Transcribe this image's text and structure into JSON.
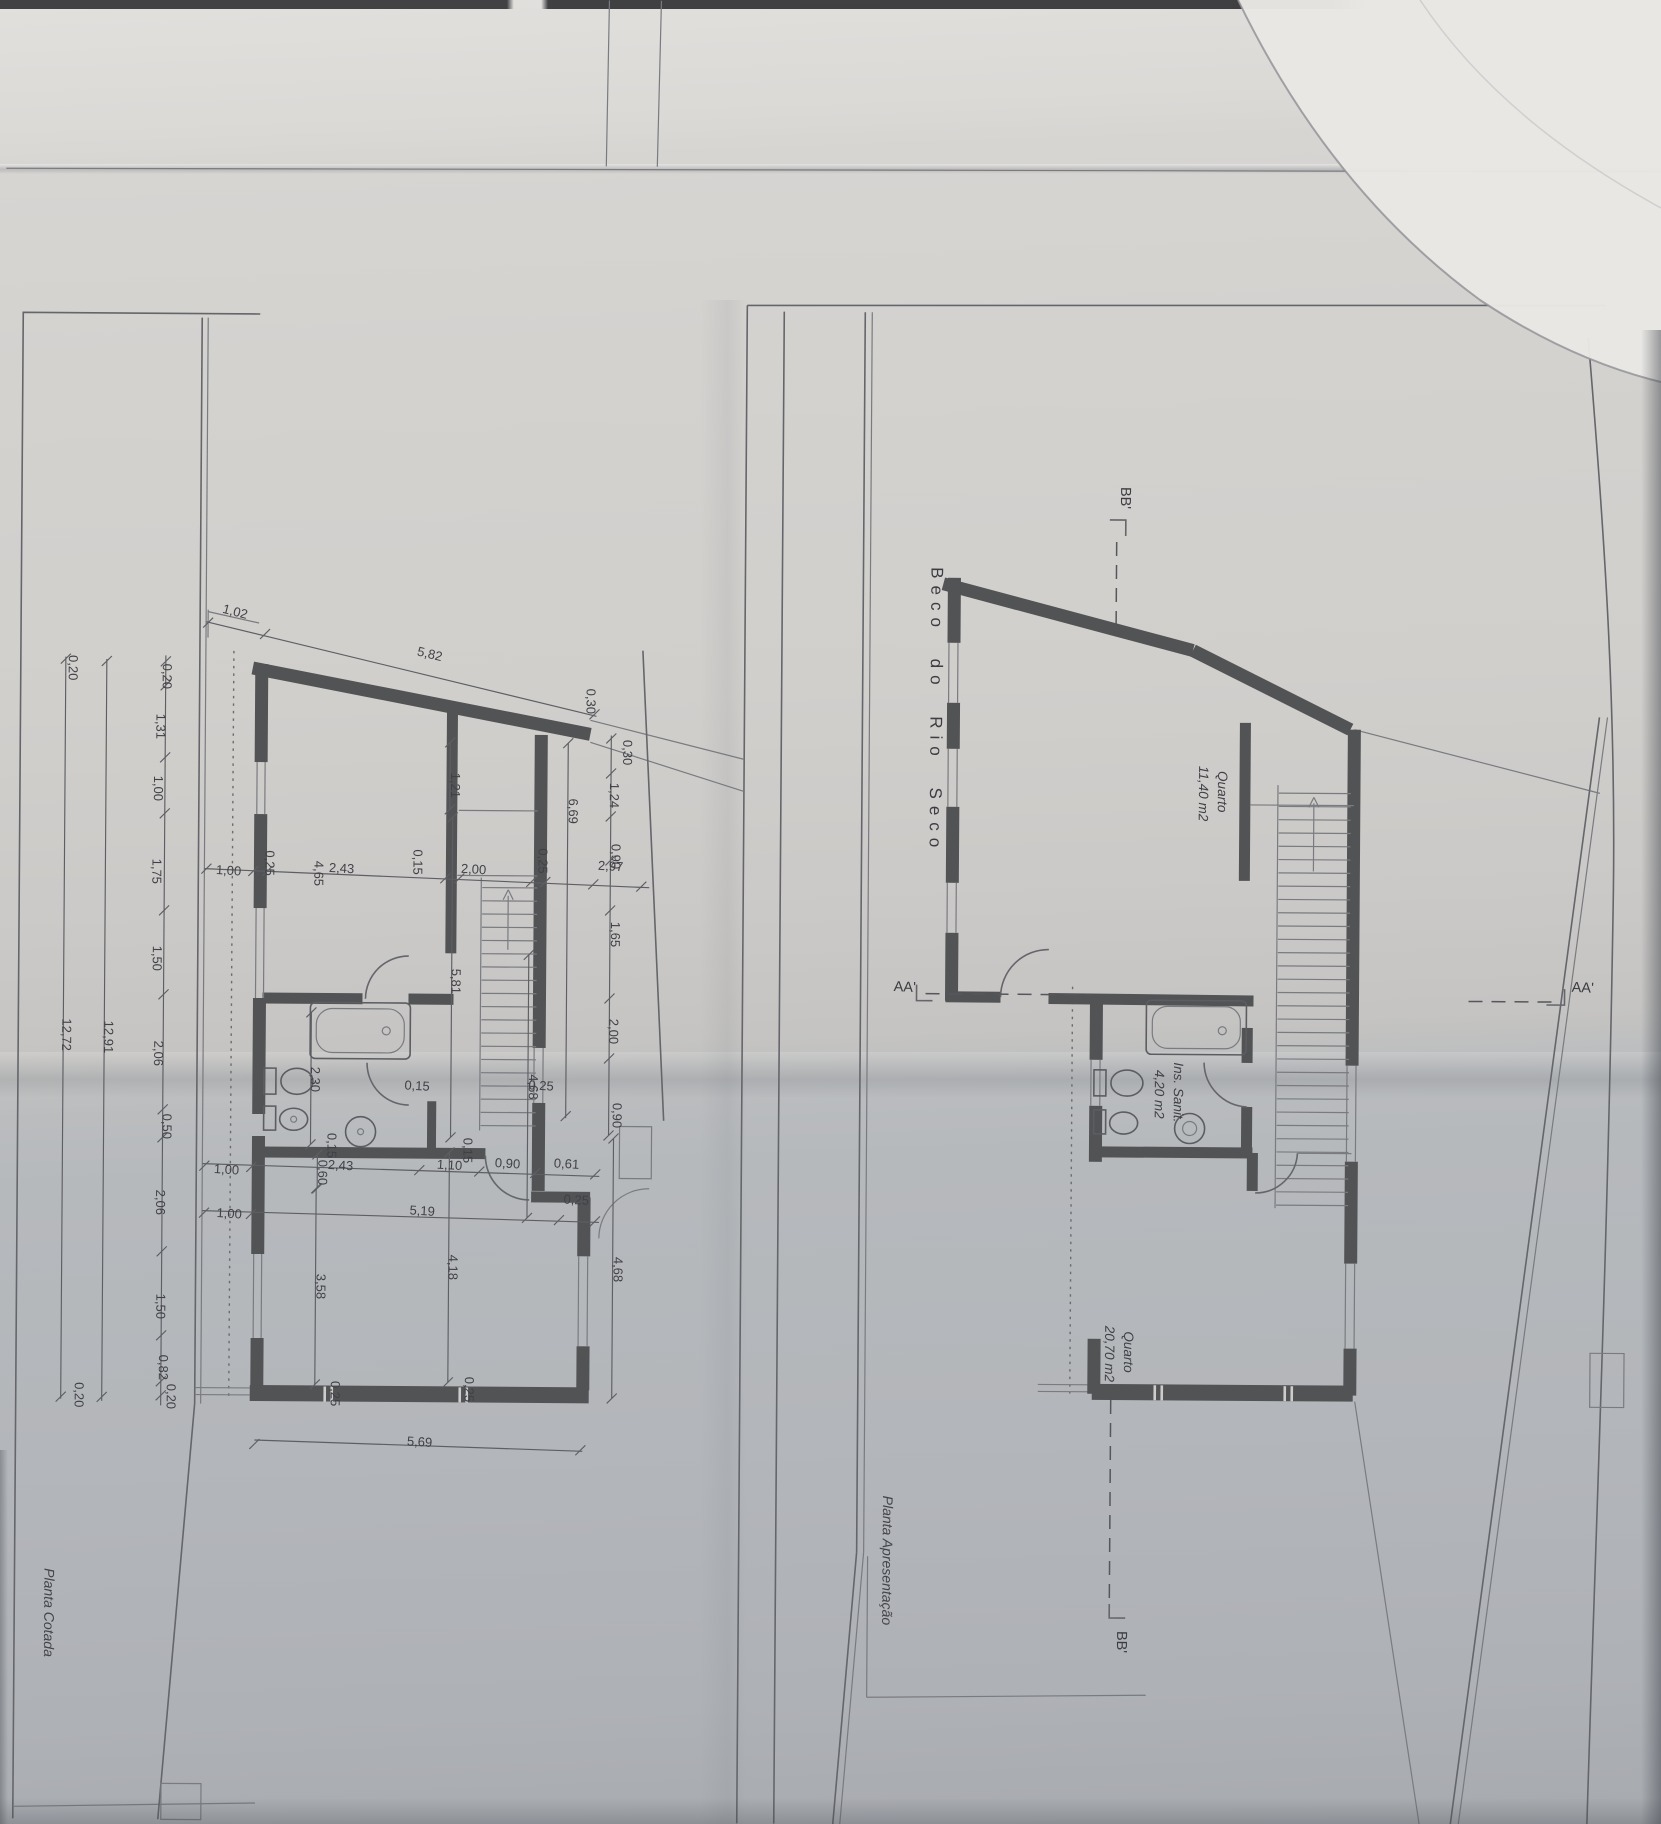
{
  "colors": {
    "paper_top": "#dbd9d6",
    "paper_bottom": "#aeb1b6",
    "wall_ink": "#525355",
    "line_ink": "#64666b",
    "text_ink": "#404147"
  },
  "left_plan": {
    "caption": "Planta Cotada",
    "caption_pos": {
      "x": 48,
      "y": 1618,
      "r": 90
    },
    "dimensions": [
      {
        "t": "0,20",
        "x": 160,
        "y": 681,
        "r": 90
      },
      {
        "t": "1,31",
        "x": 154,
        "y": 731,
        "r": 90
      },
      {
        "t": "1,00",
        "x": 152,
        "y": 793,
        "r": 90
      },
      {
        "t": "1,75",
        "x": 151,
        "y": 876,
        "r": 90
      },
      {
        "t": "1,50",
        "x": 152,
        "y": 963,
        "r": 90
      },
      {
        "t": "2,06",
        "x": 154,
        "y": 1058,
        "r": 90
      },
      {
        "t": "0,50",
        "x": 163,
        "y": 1131,
        "r": 90
      },
      {
        "t": "2,06",
        "x": 157,
        "y": 1207,
        "r": 90
      },
      {
        "t": "1,50",
        "x": 158,
        "y": 1311,
        "r": 90
      },
      {
        "t": "0,82",
        "x": 161,
        "y": 1372,
        "r": 90
      },
      {
        "t": "0,20",
        "x": 169,
        "y": 1401,
        "r": 90
      },
      {
        "t": "12,91",
        "x": 104,
        "y": 1042,
        "r": 90
      },
      {
        "t": "12,72",
        "x": 62,
        "y": 1040,
        "r": 90
      },
      {
        "t": "0,20",
        "x": 66,
        "y": 673,
        "r": 90
      },
      {
        "t": "0,20",
        "x": 77,
        "y": 1400,
        "r": 90
      },
      {
        "t": "1,02",
        "x": 231,
        "y": 620,
        "r": 14
      },
      {
        "t": "5,82",
        "x": 426,
        "y": 661,
        "r": 13
      },
      {
        "t": "1,00",
        "x": 227,
        "y": 879,
        "r": 3
      },
      {
        "t": "0,25",
        "x": 264,
        "y": 867,
        "r": 90
      },
      {
        "t": "4,65",
        "x": 313,
        "y": 877,
        "r": 90
      },
      {
        "t": "2,43",
        "x": 340,
        "y": 876,
        "r": 3
      },
      {
        "t": "0,15",
        "x": 412,
        "y": 865,
        "r": 90
      },
      {
        "t": "2,00",
        "x": 472,
        "y": 876,
        "r": 3
      },
      {
        "t": "0,25",
        "x": 537,
        "y": 863,
        "r": 90
      },
      {
        "t": "2,97",
        "x": 609,
        "y": 872,
        "r": 3
      },
      {
        "t": "0,30",
        "x": 621,
        "y": 754,
        "r": 90
      },
      {
        "t": "1,24",
        "x": 608,
        "y": 797,
        "r": 90
      },
      {
        "t": "0,90",
        "x": 610,
        "y": 858,
        "r": 90
      },
      {
        "t": "1,65",
        "x": 610,
        "y": 936,
        "r": 90
      },
      {
        "t": "2,00",
        "x": 609,
        "y": 1033,
        "r": 90
      },
      {
        "t": "0,90",
        "x": 613,
        "y": 1117,
        "r": 90
      },
      {
        "t": "4,68",
        "x": 615,
        "y": 1271,
        "r": 90
      },
      {
        "t": "6,69",
        "x": 567,
        "y": 813,
        "r": 90
      },
      {
        "t": "4,68",
        "x": 529,
        "y": 1089,
        "r": 90
      },
      {
        "t": "0,30",
        "x": 584,
        "y": 703,
        "r": 90
      },
      {
        "t": "1,21",
        "x": 449,
        "y": 788,
        "r": 90
      },
      {
        "t": "5,81",
        "x": 451,
        "y": 984,
        "r": 90
      },
      {
        "t": "2,30",
        "x": 311,
        "y": 1083,
        "r": 90
      },
      {
        "t": "0,15",
        "x": 328,
        "y": 1149,
        "r": 90
      },
      {
        "t": "0,60",
        "x": 319,
        "y": 1176,
        "r": 90
      },
      {
        "t": "0,15",
        "x": 464,
        "y": 1153,
        "r": 90
      },
      {
        "t": "3,58",
        "x": 318,
        "y": 1290,
        "r": 90
      },
      {
        "t": "4,18",
        "x": 450,
        "y": 1270,
        "r": 90
      },
      {
        "t": "1,00",
        "x": 227,
        "y": 1178,
        "r": 3
      },
      {
        "t": "2,43",
        "x": 341,
        "y": 1173,
        "r": 3
      },
      {
        "t": "1,10",
        "x": 450,
        "y": 1172,
        "r": 3
      },
      {
        "t": "0,90",
        "x": 508,
        "y": 1170,
        "r": 3
      },
      {
        "t": "0,61",
        "x": 567,
        "y": 1170,
        "r": 3
      },
      {
        "t": "0,15",
        "x": 417,
        "y": 1093,
        "r": 3
      },
      {
        "t": "0,25",
        "x": 541,
        "y": 1092,
        "r": 3
      },
      {
        "t": "1,00",
        "x": 230,
        "y": 1222,
        "r": 3
      },
      {
        "t": "5,19",
        "x": 423,
        "y": 1218,
        "r": 3
      },
      {
        "t": "0,25",
        "x": 577,
        "y": 1206,
        "r": 3
      },
      {
        "t": "5,69",
        "x": 422,
        "y": 1449,
        "r": 3
      },
      {
        "t": "0,25",
        "x": 333,
        "y": 1397,
        "r": 90
      },
      {
        "t": "0,25",
        "x": 467,
        "y": 1392,
        "r": 90
      }
    ]
  },
  "right_plan": {
    "caption": "Planta Apresentação",
    "caption_pos": {
      "x": 886,
      "y": 1560,
      "r": 90
    },
    "street_label": {
      "t": "Beco do Rio Seco",
      "x": 928,
      "y": 710,
      "r": 90
    },
    "rooms": [
      {
        "name": "Quarto",
        "area": "11,40 m2",
        "x": 1207,
        "y": 789
      },
      {
        "name": "Ins. Sanit.",
        "area": "4,20 m2",
        "x": 1165,
        "y": 1090
      },
      {
        "name": "Quarto",
        "area": "20,70 m2",
        "x": 1117,
        "y": 1350
      }
    ],
    "section_marks": [
      {
        "t": "BB'",
        "x": 1117,
        "y": 496,
        "r": 90
      },
      {
        "t": "AA'",
        "x": 904,
        "y": 991,
        "r": 2
      },
      {
        "t": "AA'",
        "x": 1582,
        "y": 987,
        "r": 2
      },
      {
        "t": "BB'",
        "x": 1121,
        "y": 1640,
        "r": 90
      }
    ]
  }
}
